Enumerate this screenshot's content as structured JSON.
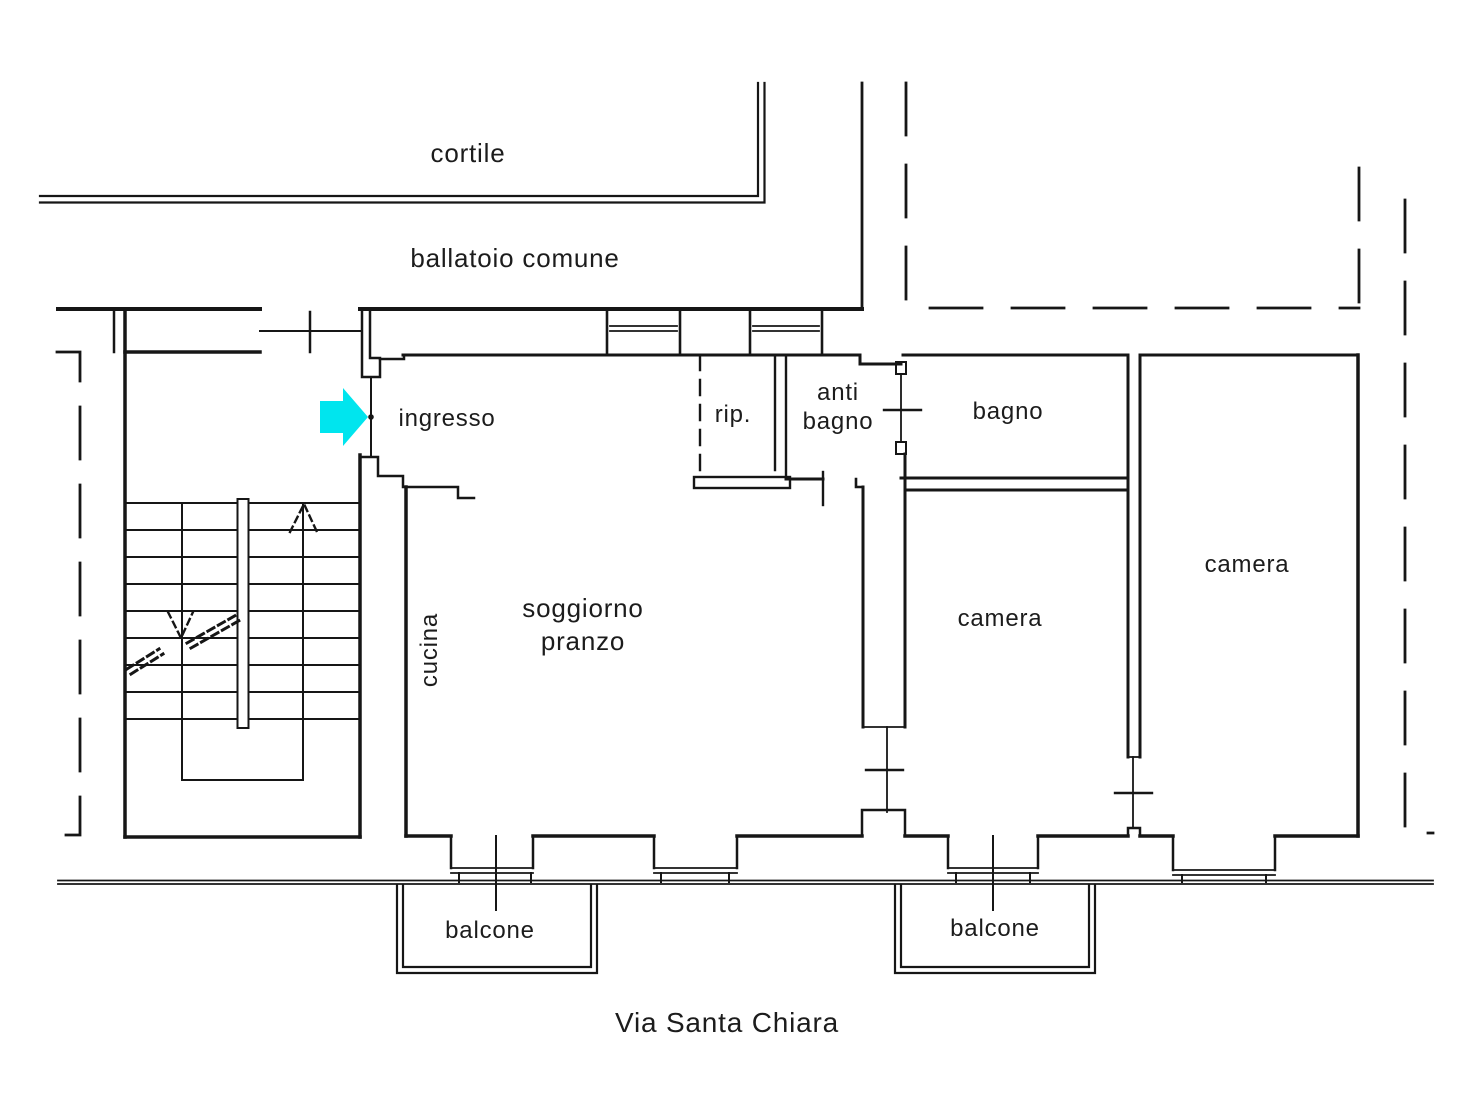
{
  "title": "apartment floor plan",
  "labels": {
    "cortile": "cortile",
    "ballatoio": "ballatoio comune",
    "ingresso": "ingresso",
    "rip": "rip.",
    "anti_line1": "anti",
    "anti_line2": "bagno",
    "bagno": "bagno",
    "camera_right": "camera",
    "soggiorno_line1": "soggiorno",
    "soggiorno_line2": "pranzo",
    "cucina": "cucina",
    "camera_middle": "camera",
    "balcone_left": "balcone",
    "balcone_right": "balcone",
    "street": "Via Santa Chiara"
  },
  "colors": {
    "line": "#161616",
    "background": "#ffffff",
    "entrance_arrow": "#00e5ee"
  }
}
